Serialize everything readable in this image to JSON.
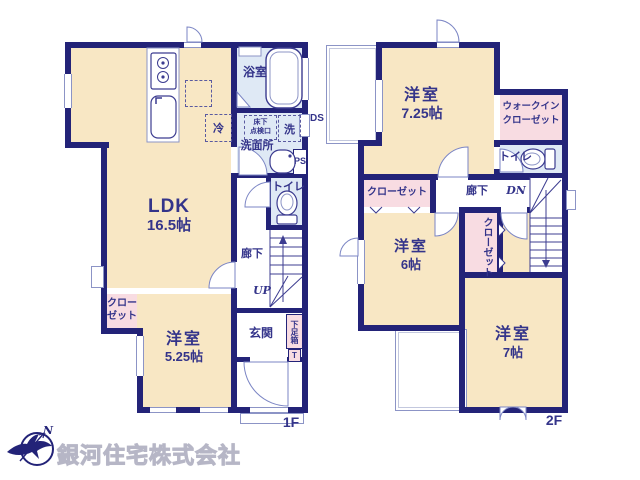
{
  "colors": {
    "wall_navy": "#232378",
    "text_navy": "#34348a",
    "room_cream": "#f8e7c4",
    "closet_pink": "#f8dce2",
    "wet_blue": "#dfe9f5",
    "line_blue": "#8c94c6",
    "logo_gray": "#c9c9d4"
  },
  "company": {
    "name": "銀河住宅株式会社",
    "north_label": "N"
  },
  "floor1": {
    "label": "1F",
    "ldk": {
      "name": "LDK",
      "size": "16.5帖"
    },
    "bedroom": {
      "name": "洋室",
      "size": "5.25帖"
    },
    "bath": "浴室",
    "washroom": "洗面所",
    "washer": "洗",
    "fridge": "冷",
    "underfloor_l1": "床下",
    "underfloor_l2": "点検口",
    "toilet": "トイレ",
    "hallway": "廊下",
    "stairs": "UP",
    "closet_l1": "クロー",
    "closet_l2": "ゼット",
    "entrance": "玄関",
    "shoe_box": "下足箱",
    "shoe_box_tag": "T",
    "duct": "DS",
    "pipe": "PS"
  },
  "floor2": {
    "label": "2F",
    "bedroom1": {
      "name": "洋室",
      "size": "7.25帖"
    },
    "walkin_l1": "ウォークイン",
    "walkin_l2": "クローゼット",
    "toilet": "トイレ",
    "closet_a": "クローゼット",
    "closet_b": "クローゼット",
    "hallway": "廊下",
    "stairs": "DN",
    "bedroom2": {
      "name": "洋室",
      "size": "6帖"
    },
    "bedroom3": {
      "name": "洋室",
      "size": "7帖"
    }
  }
}
